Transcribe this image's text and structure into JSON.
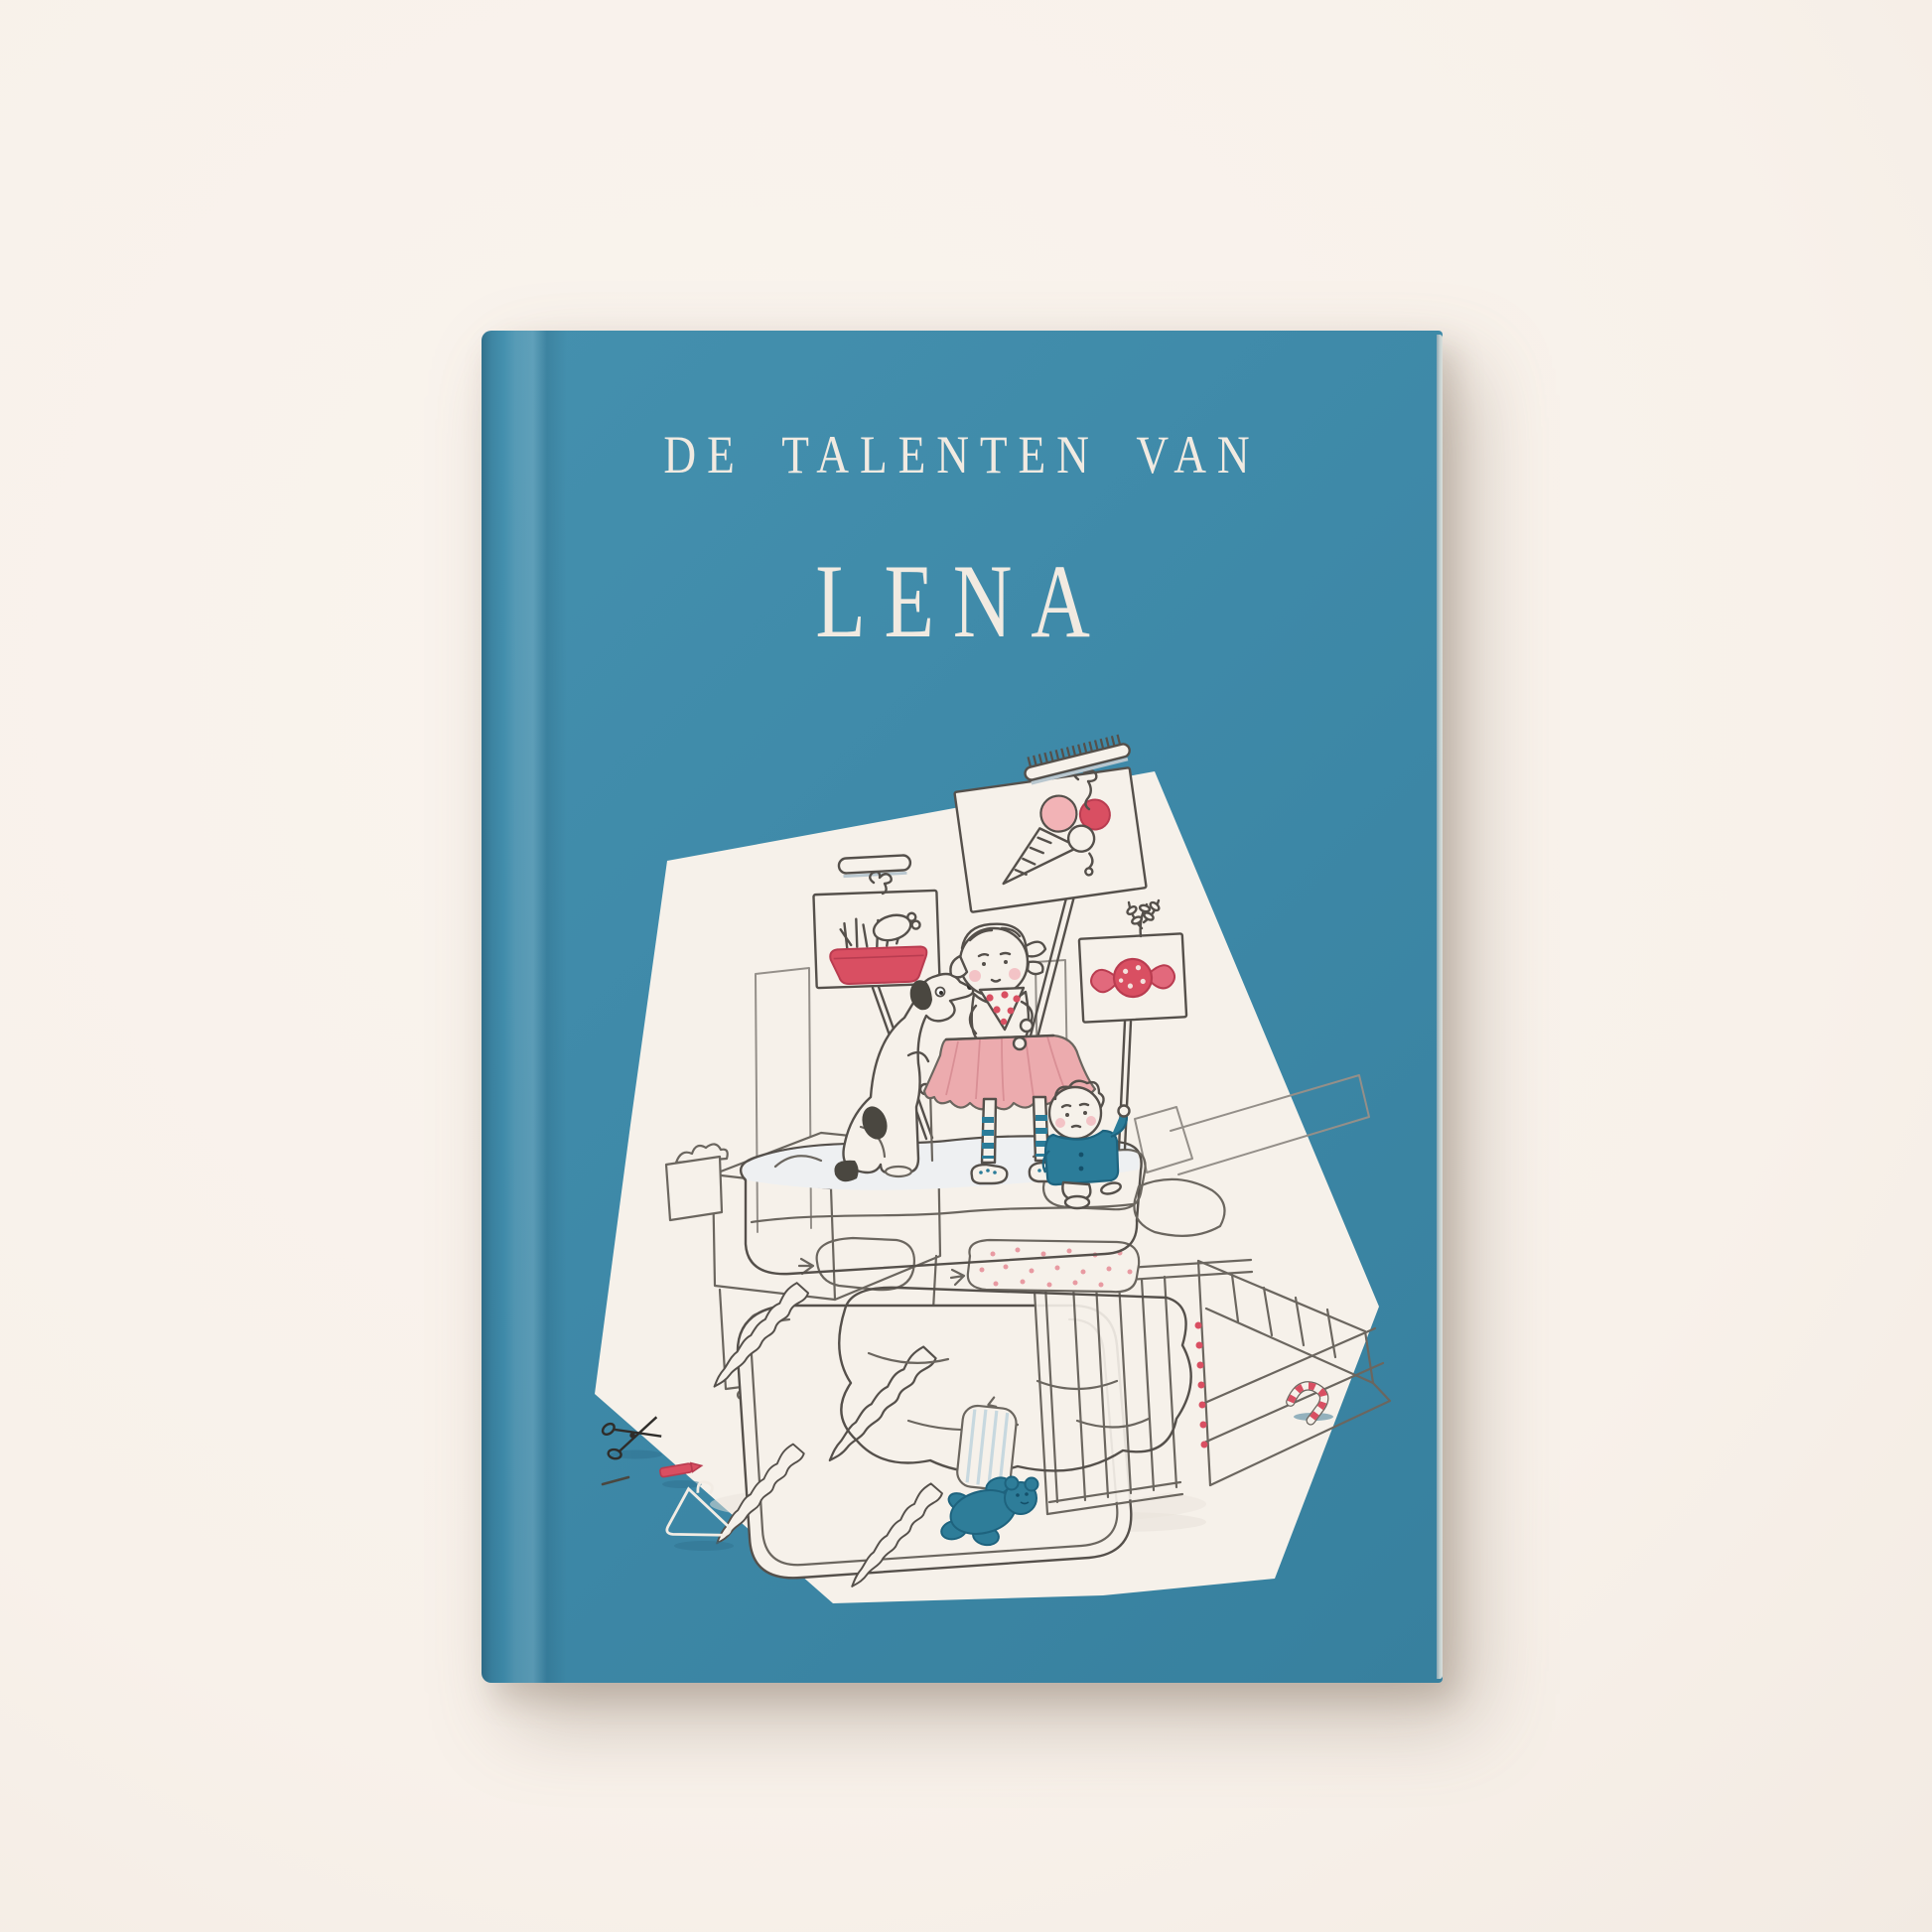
{
  "book_cover": {
    "series_label": "DE TALENTEN VAN",
    "title": "LENA"
  },
  "palette": {
    "background": "#f8f1ea",
    "cover_teal": "#3e89a8",
    "cover_teal_dark": "#37809e",
    "spine_shadow": "#2e7494",
    "panel_white": "#f6f1ea",
    "line_dark": "#55504b",
    "line_light": "#948f89",
    "accent_red": "#d94f62",
    "accent_pink": "#ecabae",
    "accent_teal": "#2b7c99",
    "mattress_blue": "#d5dee7",
    "title_text": "#f1eae1"
  },
  "illustration": {
    "elements": [
      "white-panel-pentagon",
      "comb-icon",
      "ice-cream-sign",
      "dog-bowl-sign",
      "candy-sign",
      "sprig-icon",
      "plank-icon",
      "girl-in-tutu",
      "dog",
      "boy",
      "mattress-pile",
      "pink-bolster",
      "polka-dot-pillow",
      "striped-pillow",
      "overturned-table",
      "spiral-table-legs",
      "overturned-chair",
      "overturned-crib",
      "teddy-bear",
      "scissors-icon",
      "crayon-icon",
      "clothes-hanger-icon",
      "candy-cane-icon",
      "dresser",
      "tissue-box"
    ]
  }
}
